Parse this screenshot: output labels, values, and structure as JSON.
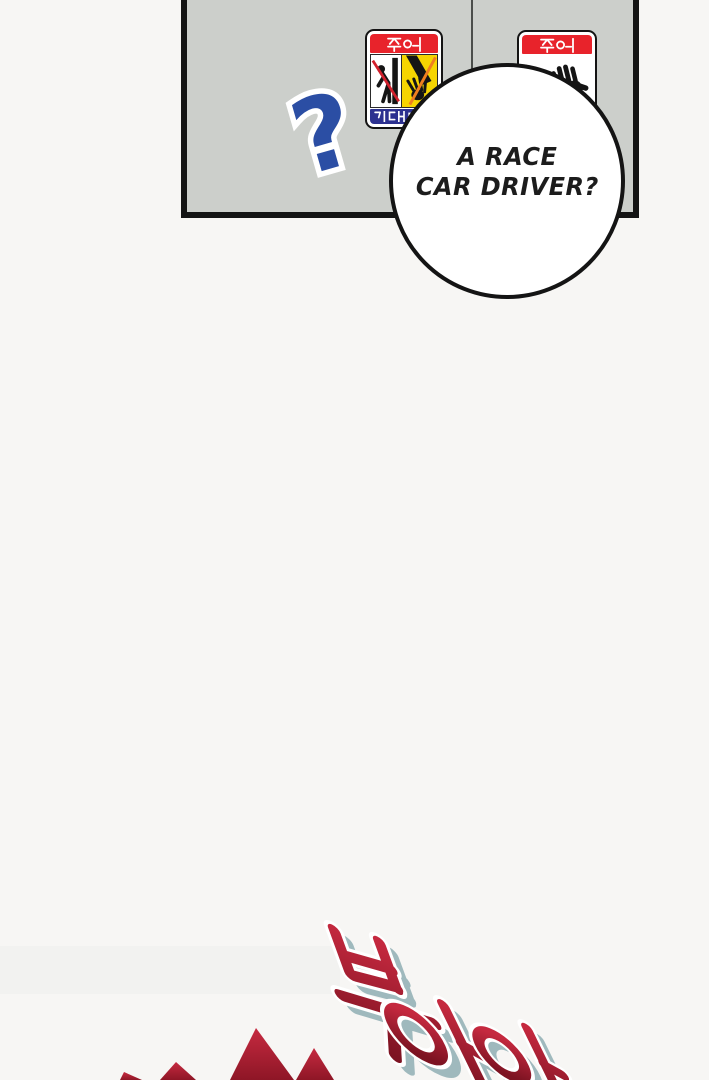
{
  "colors": {
    "bg": "#f7f6f4",
    "ink": "#141414",
    "panel-fill": "#cccfcb",
    "door-line": "#4b4e4b",
    "sticker-red": "#e8232b",
    "sticker-yellow": "#f6d501",
    "sticker-blue": "#2c3190",
    "warn-line": "#d1202c",
    "qmark-blue": "#2b4ea4",
    "bubble-text": "#1c1c1c",
    "sfx-top": "#c5293f",
    "sfx-bottom": "#7d1322",
    "sfx-shadow": "#9fb9bd",
    "spike-red": "#c62a40",
    "spike-dark": "#8e1626"
  },
  "panel": {
    "description": "gray train/subway door panel with center door gap"
  },
  "stickers": {
    "left": {
      "header": "주의",
      "footer": "기대면",
      "pictograms": [
        "person-leaning-on-door-prohibited",
        "hand-caught-in-door"
      ]
    },
    "right": {
      "header": "주의",
      "pictograms": [
        "hand-touch-prohibited"
      ]
    }
  },
  "question_mark": {
    "glyph": "?"
  },
  "bubble": {
    "line1": "A RACE",
    "line2": "CAR DRIVER?"
  },
  "sfx": {
    "text": "부아아",
    "chars": [
      "부",
      "아",
      "아"
    ]
  }
}
